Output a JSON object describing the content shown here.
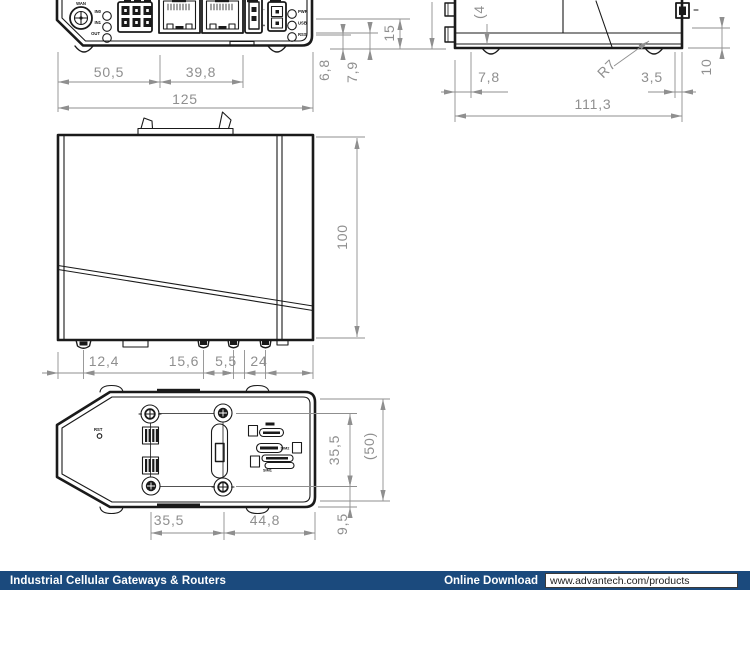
{
  "dims": {
    "front": {
      "w1": "50,5",
      "w2": "39,8",
      "total": "125",
      "s1": "6,8",
      "s2": "7,9",
      "s3": "15"
    },
    "right": {
      "cut": "(4",
      "d1": "7,8",
      "d2": "3,5",
      "total": "111,3",
      "radius": "R7",
      "height": "10"
    },
    "side": {
      "height": "100",
      "b1": "12,4",
      "b2": "15,6",
      "b3": "5,5",
      "b4": "24"
    },
    "bottom": {
      "w1": "35,5",
      "w2": "44,8",
      "h1": "35,5",
      "total": "(50)",
      "h2": "9,5"
    }
  },
  "panel": {
    "antenna": "WAN",
    "in0": "IN0",
    "in1": "IN1",
    "out": "OUT",
    "led_pwr": "PWR",
    "led_usb": "USB",
    "led_rss": "RSS",
    "plus": "+",
    "minus": "-"
  },
  "bottom_labels": {
    "reset": "RST",
    "sim2": "SIM2",
    "sim1": "SIM1"
  },
  "footer": {
    "category": "Industrial Cellular Gateways & Routers",
    "download_label": "Online Download",
    "url": "www.advantech.com/products"
  }
}
